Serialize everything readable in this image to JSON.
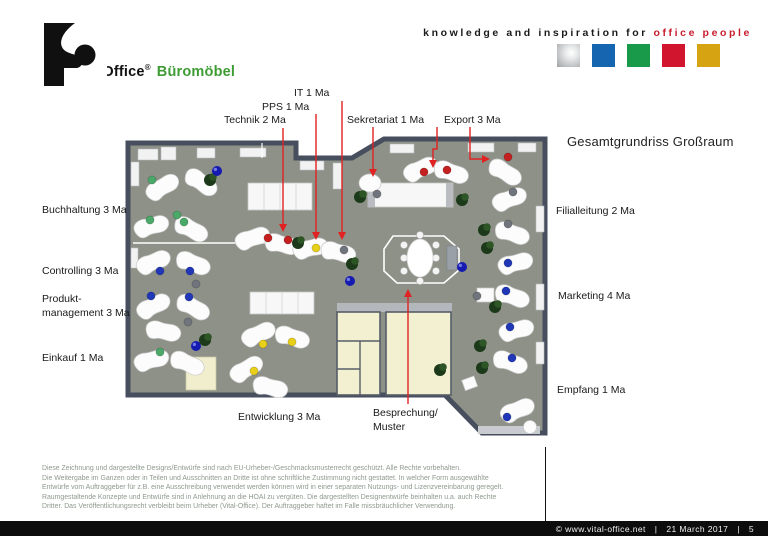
{
  "header": {
    "logo": {
      "brand": "Vital-Office",
      "reg": "®",
      "suffix": "Büromöbel"
    },
    "tagline": {
      "black": "knowledge and inspiration for ",
      "red": "office people"
    },
    "palette": [
      {
        "name": "silver",
        "hex": "#b9babc"
      },
      {
        "name": "blue",
        "hex": "#1565b0"
      },
      {
        "name": "green",
        "hex": "#189a4a"
      },
      {
        "name": "red",
        "hex": "#d2152e"
      },
      {
        "name": "gold",
        "hex": "#d6a312"
      }
    ],
    "brand_green": "#3f9c35",
    "brand_red": "#c81e2e"
  },
  "plan": {
    "title": "Gesamtgrundriss Großraum",
    "annotation_color": "#e02222",
    "labels": {
      "it": "IT 1 Ma",
      "pps": "PPS 1 Ma",
      "technik": "Technik 2 Ma",
      "sekretariat": "Sekretariat 1 Ma",
      "export": "Export 3 Ma",
      "buchhaltung": "Buchhaltung 3 Ma",
      "controlling": "Controlling 3 Ma",
      "produkt_line1": "Produkt-",
      "produkt_line2": "management 3 Ma",
      "einkauf": "Einkauf 1 Ma",
      "entwicklung": "Entwicklung 3 Ma",
      "besprechung_line1": "Besprechung/",
      "besprechung_line2": "Muster",
      "filialleitung": "Filialleitung 2 Ma",
      "marketing": "Marketing 4 Ma",
      "empfang": "Empfang 1 Ma"
    }
  },
  "disclaimer": {
    "lines": [
      "Diese Zeichnung und dargestellte Designs/Entwürfe sind nach EU-Urheber-/Geschmacksmusterrecht geschützt. Alle Rechte vorbehalten.",
      "Die Weitergabe im Ganzen oder in Teilen und Ausschnitten an Dritte ist ohne schriftliche Zustimmung nicht gestattet. In welcher Form ausgewählte",
      "Entwürfe vom Auftraggeber für z.B. eine Ausschreibung verwendet werden können wird in einer separaten Nutzungs- und Lizenzvereinbarung geregelt.",
      "Raumgestaltende Konzepte und Entwürfe sind in Anlehnung an die HOAI zu vergüten. Die dargestellten Designentwürfe beinhalten u.a. auch Rechte",
      "Dritter. Das Veröffentlichungsrecht verbleibt beim Urheber (Vital-Office). Der Auftraggeber haftet im Falle missbräuchlicher Verwendung."
    ]
  },
  "footer": {
    "copyright": "©  www.vital-office.net",
    "sep1": "|",
    "date": "21 March 2017",
    "sep2": "|",
    "page": "5"
  }
}
